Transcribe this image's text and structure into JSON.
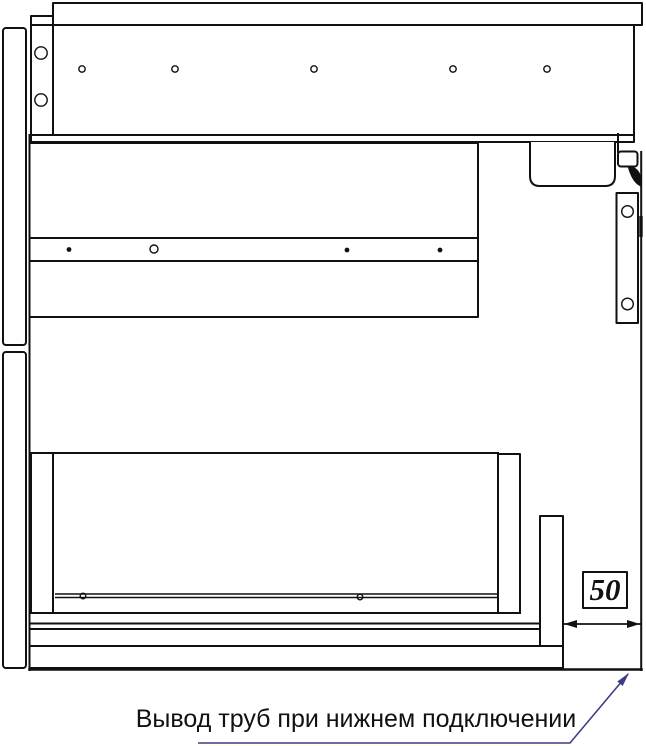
{
  "drawing": {
    "annotation": "Вывод труб при нижнем подключении",
    "dimension": {
      "value": "50"
    },
    "colors": {
      "line": "#111111",
      "leader_line": "#3d3d85",
      "background": "#ffffff",
      "text": "#111111"
    }
  }
}
